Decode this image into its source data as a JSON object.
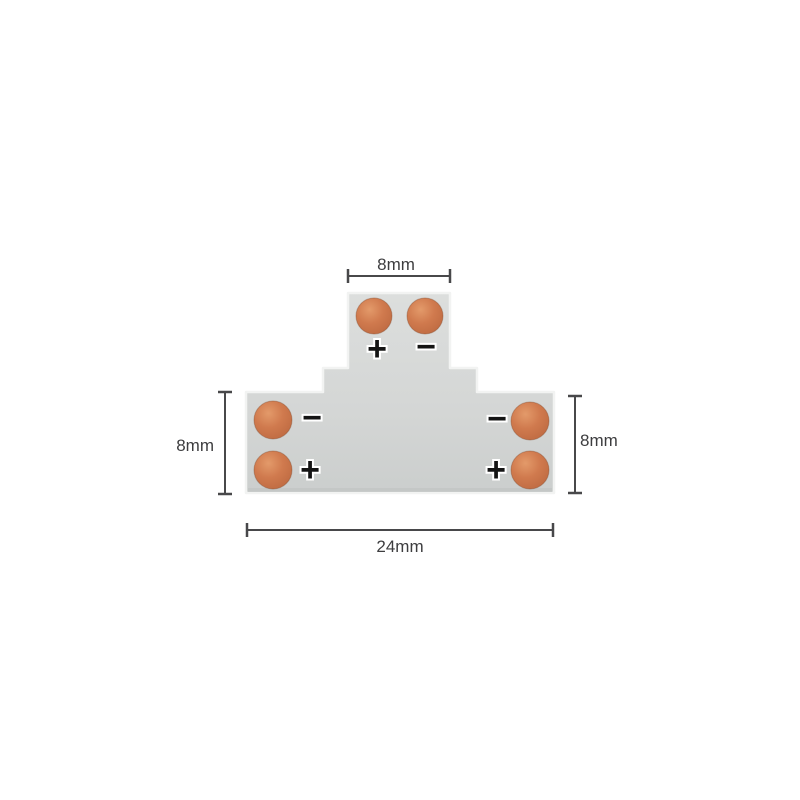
{
  "page": {
    "background": "#ffffff"
  },
  "diagram": {
    "subject": "t-shape-led-strip-connector",
    "colors": {
      "board": "#d5d7d6",
      "board_edge_highlight": "#f2f3f2",
      "board_bottom_shade": "#bfc2c1",
      "pad": "#cd7a52",
      "pad_rim": "#ad5f3c",
      "dimension_lines": "#48484a",
      "dimension_text": "#3d3d3f",
      "polarity_mark": "#141414"
    },
    "dimensions": {
      "top_width": {
        "label": "8mm"
      },
      "left_height": {
        "label": "8mm"
      },
      "right_height": {
        "label": "8mm"
      },
      "bottom_width": {
        "label": "24mm"
      }
    },
    "terminals": {
      "top_plus": "+",
      "top_minus": "−",
      "left_minus": "−",
      "left_plus": "+",
      "right_minus": "−",
      "right_plus": "+"
    }
  }
}
